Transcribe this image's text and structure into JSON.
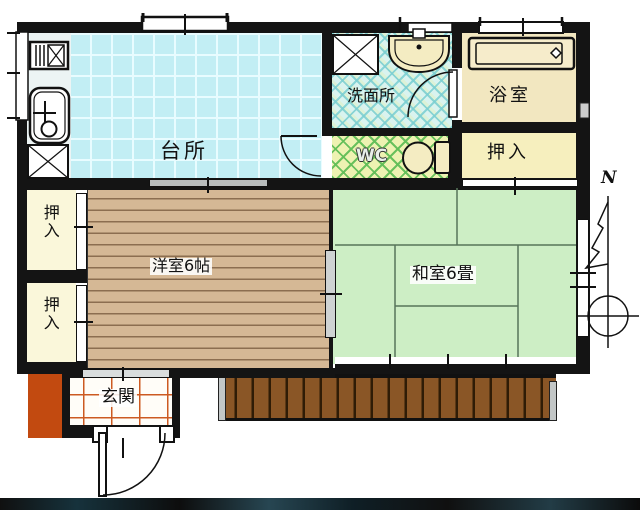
{
  "rooms": {
    "kitchen": "台所",
    "washroom": "洗面所",
    "bathroom": "浴室",
    "wc": "WC",
    "closet_top_right": "押入",
    "closet_left_upper": "押入",
    "closet_left_lower": "押入",
    "western_room": "洋室6帖",
    "japanese_room": "和室6畳",
    "entrance": "玄関"
  },
  "compass": {
    "north": "N"
  },
  "colors": {
    "wall": "#141414",
    "kitchen_tile": "#c2eef4",
    "washroom_tile": "#d9f3ef",
    "wc_tile": "#eef2b2",
    "bathroom": "#f2e7c0",
    "closet": "#f6efbe",
    "wood_floor": "#d5b895",
    "tatami": "#cdeec5",
    "deck": "#8a5626",
    "porch": "#c24a10",
    "entrance_tile_line": "#cc5a22"
  }
}
